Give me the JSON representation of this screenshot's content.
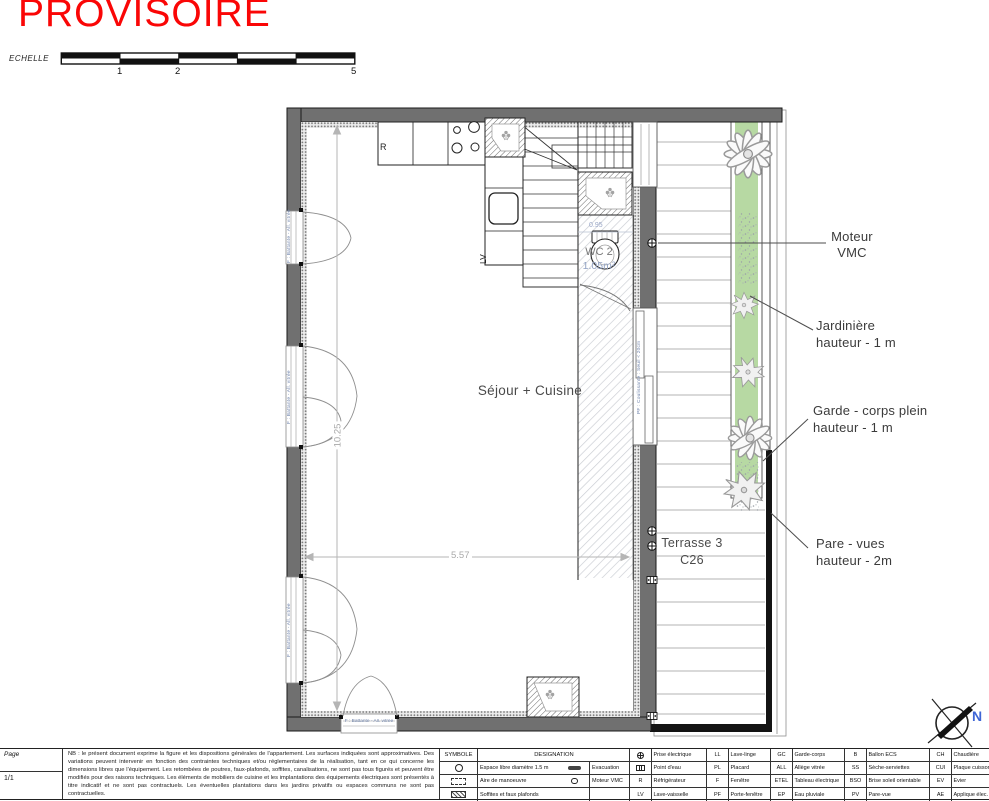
{
  "stamp": {
    "text": "PROVISOIRE"
  },
  "scalebar": {
    "label": "ECHELLE",
    "tick1": "1",
    "tick2": "2",
    "tick3": "5"
  },
  "plan": {
    "room_label": "Séjour + Cuisine",
    "wc_label": "WC 2",
    "wc_area": "1.05m²",
    "terrace_label": "Terrasse 3",
    "terrace_code": "C26",
    "fridge_label": "R",
    "dishwasher_label": "LV",
    "dim_width": "5.57",
    "dim_height": "10.25",
    "dim_wc": "0.95",
    "window_label_battante": "F : Battante - All. vitrée",
    "window_label_coulissante": "PF : Coulissante : Seuil < 20cm",
    "north_label": "N",
    "annotations": {
      "moteur": {
        "line1": "Moteur",
        "line2": "VMC"
      },
      "jardiniere": {
        "line1": "Jardinière",
        "line2": "hauteur - 1 m"
      },
      "garde": {
        "line1": "Garde - corps plein",
        "line2": "hauteur - 1 m"
      },
      "pare": {
        "line1": "Pare - vues",
        "line2": "hauteur - 2m"
      }
    },
    "colors": {
      "planter_green": "#b7d9a3",
      "stamp_red": "#fa0606",
      "north_blue": "#3f66d6"
    }
  },
  "footer": {
    "page_label": "Page",
    "page_value": "1/1",
    "nb_text": "NB : le présent document exprime la figure et les dispositions générales de l'appartement. Les surfaces indiquées sont approximatives. Des variations peuvent intervenir en fonction des contraintes techniques et/ou réglementaires de la réalisation, tant en ce qui concerne les dimensions libres que l'équipement. Les retombées de poutres, faux-plafonds, soffites, canalisations, ne sont pas tous figurés et peuvent être modifiés pour des raisons techniques. Les éléments de mobiliers de cuisine et les implantations des équipements électriques sont présentés à titre indicatif et ne sont pas contractuels. Les éventuelles plantations dans les jardins privatifs ou espaces communs ne sont pas contractuelles.",
    "legend": {
      "col_symbole": "SYMBOLE",
      "col_designation": "DESIGNATION",
      "row1_d1": "Espace libre diamètre 1.5 m",
      "row1_d2": "Evacuation",
      "row2_d1": "Aire de manoeuvre",
      "row2_d2": "Moteur VMC",
      "row3_d1": "Soffites et faux plafonds"
    },
    "abbr": {
      "c1r1_label": "Prise électrique",
      "c1r2_label": "Point d'eau",
      "c1r3_key": "R",
      "c1r3_label": "Réfrigérateur",
      "c1r4_key": "LV",
      "c1r4_label": "Lave-vaisselle",
      "c2r1_key": "LL",
      "c2r1_label": "Lave-linge",
      "c2r2_key": "PL",
      "c2r2_label": "Placard",
      "c2r3_key": "F",
      "c2r3_label": "Fenêtre",
      "c2r4_key": "PF",
      "c2r4_label": "Porte-fenêtre",
      "c3r1_key": "GC",
      "c3r1_label": "Garde-corps",
      "c3r2_key": "ALL",
      "c3r2_label": "Allège vitrée",
      "c3r3_key": "ETEL",
      "c3r3_label": "Tableau électrique",
      "c3r4_key": "EP",
      "c3r4_label": "Eau pluviale",
      "c4r1_key": "B",
      "c4r1_label": "Ballon ECS",
      "c4r2_key": "SS",
      "c4r2_label": "Sèche-serviettes",
      "c4r3_key": "BSO",
      "c4r3_label": "Brise soleil orientable",
      "c4r4_key": "PV",
      "c4r4_label": "Pare-vue",
      "c5r1_key": "CH",
      "c5r1_label": "Chaudière",
      "c5r2_key": "CUI",
      "c5r2_label": "Plaque cuisson",
      "c5r3_key": "EV",
      "c5r3_label": "Evier",
      "c5r4_key": "AE",
      "c5r4_label": "Applique élec."
    }
  }
}
